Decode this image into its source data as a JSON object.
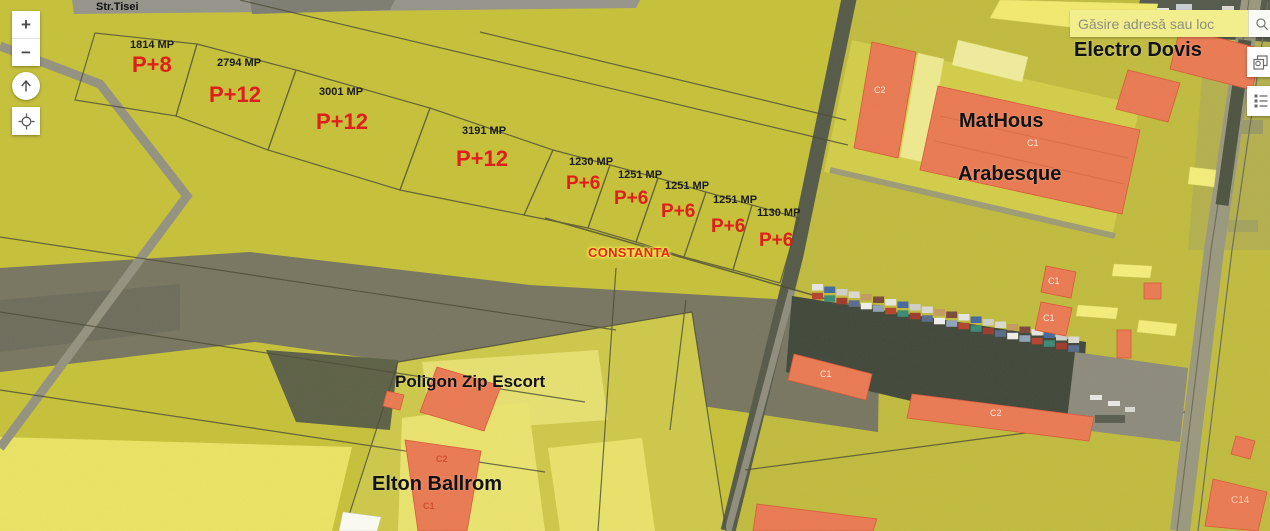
{
  "search": {
    "placeholder": "Găsire adresă sau loc"
  },
  "controls": {
    "zoom_in": "+",
    "zoom_out": "−"
  },
  "street_label": "Str.Tisei",
  "city_label": "CONSTANTA",
  "place_labels": {
    "electro_dovis": "Electro Dovis",
    "mathous": "MatHous",
    "arabesque": "Arabesque",
    "poligon": "Poligon Zip Escort",
    "elton": "Elton Ballrom"
  },
  "parcels": [
    {
      "area": "1814 MP",
      "regime": "P+8"
    },
    {
      "area": "2794 MP",
      "regime": "P+12"
    },
    {
      "area": "3001 MP",
      "regime": "P+12"
    },
    {
      "area": "3191 MP",
      "regime": "P+12"
    },
    {
      "area": "1230 MP",
      "regime": "P+6"
    },
    {
      "area": "1251 MP",
      "regime": "P+6"
    },
    {
      "area": "1251 MP",
      "regime": "P+6"
    },
    {
      "area": "1251 MP",
      "regime": "P+6"
    },
    {
      "area": "1130 MP",
      "regime": "P+6"
    }
  ],
  "building_labels": {
    "c1": "C1",
    "c2": "C2",
    "c14": "C14"
  },
  "colors": {
    "overlay_yellow": "#c6c139",
    "highlight_yellow": "#f3ed7a",
    "building_orange": "#e97a52",
    "regime_red": "#e01f1c",
    "city_red": "#e02517"
  }
}
